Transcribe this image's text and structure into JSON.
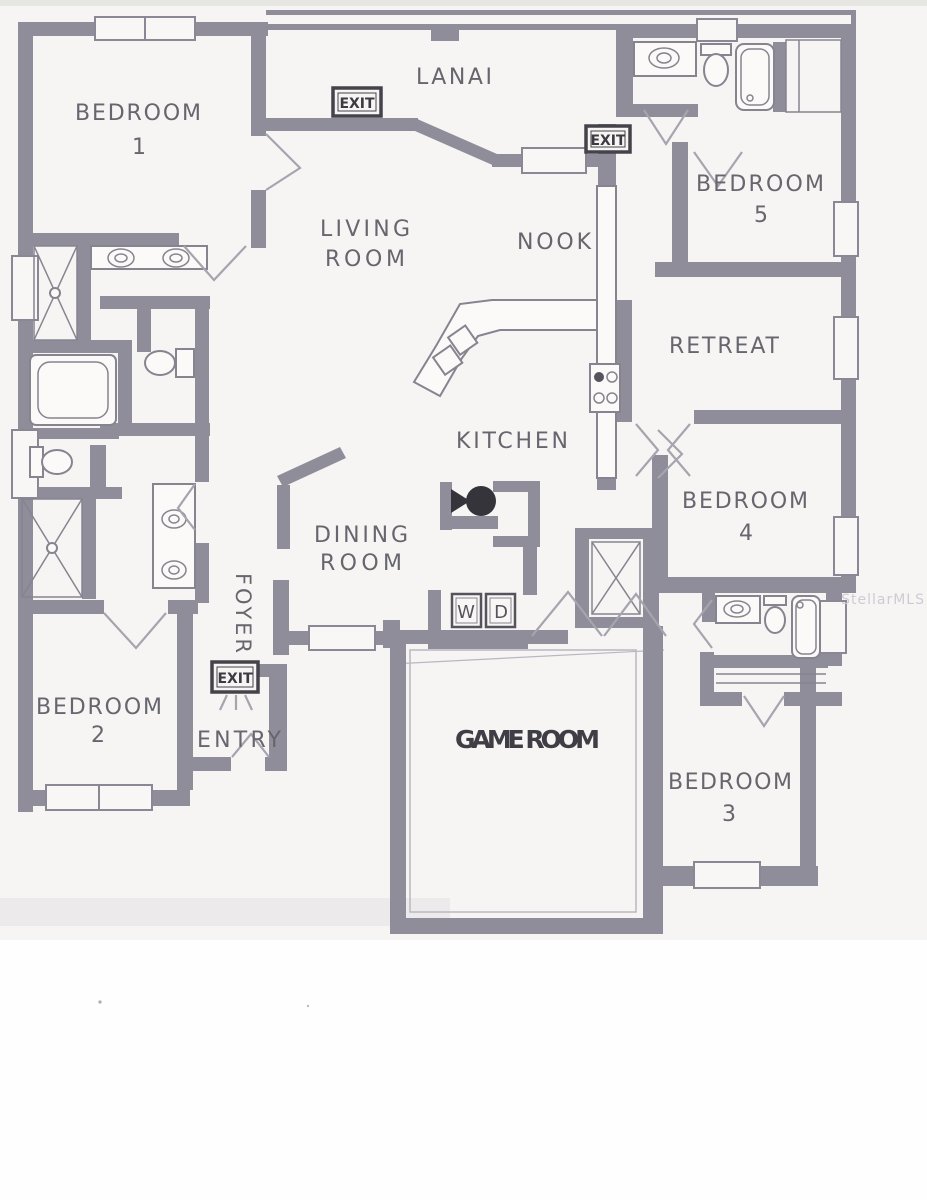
{
  "watermark": "StellarMLS",
  "rooms": {
    "bedroom1": {
      "name": "BEDROOM",
      "num": "1"
    },
    "bedroom2": {
      "name": "BEDROOM",
      "num": "2"
    },
    "bedroom3": {
      "name": "BEDROOM",
      "num": "3"
    },
    "bedroom4": {
      "name": "BEDROOM",
      "num": "4"
    },
    "bedroom5": {
      "name": "BEDROOM",
      "num": "5"
    },
    "lanai": {
      "name": "LANAI"
    },
    "living": {
      "line1": "LIVING",
      "line2": "ROOM"
    },
    "nook": {
      "name": "NOOK"
    },
    "kitchen": {
      "name": "KITCHEN"
    },
    "retreat": {
      "name": "RETREAT"
    },
    "dining": {
      "line1": "DINING",
      "line2": "ROOM"
    },
    "foyer": {
      "name": "FOYER"
    },
    "entry": {
      "name": "ENTRY"
    },
    "game": {
      "name": "GAME ROOM"
    }
  },
  "signs": {
    "exit1": "EXIT",
    "exit2": "EXIT",
    "exit3": "EXIT"
  },
  "appliances": {
    "washer": "W",
    "dryer": "D"
  },
  "colors": {
    "wall": "#8f8d99",
    "label_text": "#67666e",
    "game_text": "#403e45",
    "exit_text": "#3c3b42",
    "watermark": "#cdccd4",
    "paper": "#f6f5f3"
  }
}
